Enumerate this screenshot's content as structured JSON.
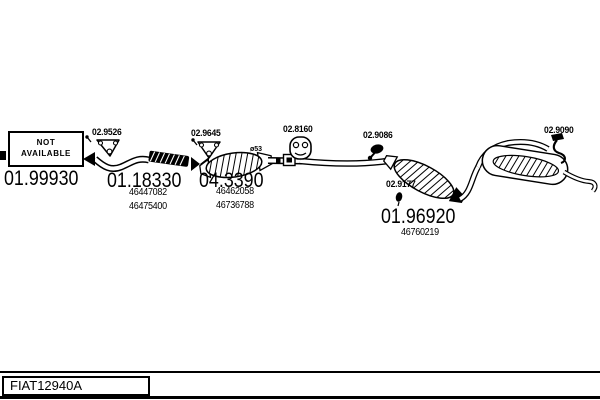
{
  "page": {
    "background": "#ffffff",
    "ink": "#000000"
  },
  "not_available_box": {
    "line1": "NOT",
    "line2": "AVAILABLE"
  },
  "footer": {
    "diagram_code": "FIAT12940A"
  },
  "parts": {
    "front_pipe": {
      "code": "01.99930"
    },
    "front_gasket": {
      "code": "02.9526"
    },
    "flex_pipe": {
      "code": "01.18330",
      "oe_numbers": [
        "46447082",
        "46475400"
      ]
    },
    "cat_gasket": {
      "code": "02.9645"
    },
    "catalytic_converter": {
      "code": "04.3390",
      "oe_numbers": [
        "46462058",
        "46736788"
      ],
      "diameter_note": "ø53"
    },
    "rubber_hanger_mid": {
      "code": "02.8160"
    },
    "clamp_rear": {
      "code": "02.9086"
    },
    "grommet": {
      "code": "02.9177"
    },
    "mid_muffler": {
      "code": "01.96920",
      "oe_numbers": [
        "46760219"
      ]
    },
    "hanger_rear": {
      "code": "02.9090"
    }
  }
}
